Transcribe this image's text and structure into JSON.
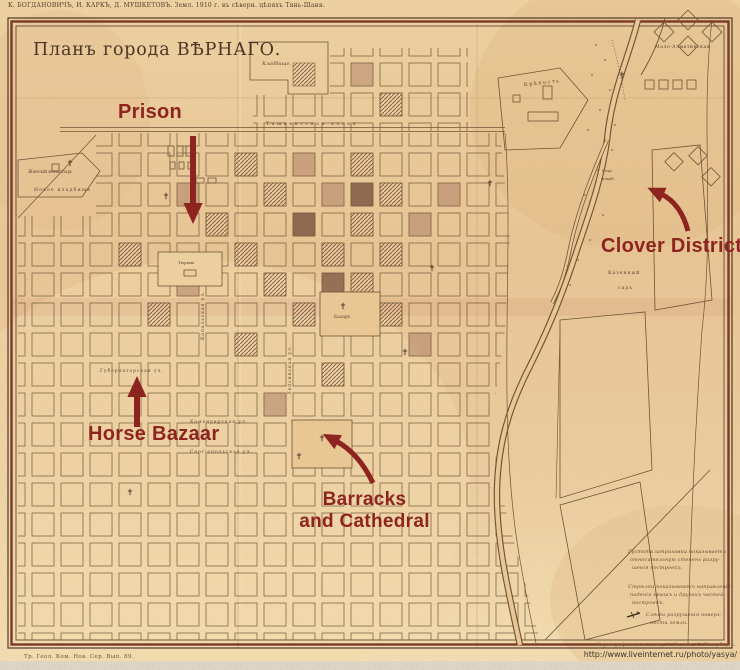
{
  "colors": {
    "annotation_red": "#8e2420",
    "paper": "#e8c795",
    "ink": "#5b4430"
  },
  "header": {
    "top_caption": "К. БОГДАНОВИЧЪ, И. КАРКЪ, Д. МУШКЕТОВЪ.  Земл. 1910 г. въ сѣверн. цѣпяхъ Тянь-Шаня.",
    "title": "Планъ города ВѢРНАГО."
  },
  "annotations": {
    "prison": "Prison",
    "clover_district": "Clover District",
    "horse_bazaar": "Horse Bazaar",
    "barracks_line1": "Barracks",
    "barracks_line2": "and Cathedral"
  },
  "map_labels": {
    "cemetery": "Кладбище.",
    "fortress": "Крѣпость",
    "convent": "Женскій монастырь",
    "new_cemetery": "Новое кладбище",
    "prison_block": "Тюрьма",
    "tashkent_alley": "Ташкентская  аллея",
    "gubernatorskaya": "Губернаторская ул.",
    "komandirskaya": "Командирская ул.",
    "sergiopolskaya": "Сергіопольская ул.",
    "kopalskaya": "Копальская ул.",
    "lepsinskaya": "Лепсинская ул.",
    "bazaar": "Базаръ",
    "state_garden_line1": "Казенный",
    "state_garden_line2": "садъ",
    "old_cemetery_line1": "Стар.",
    "old_cemetery_line2": "кладб.",
    "malo_almatinskaya": "Мало-Алматинская"
  },
  "legend": {
    "l1": "Густота штриховки показываетъ",
    "l2": "относительную степень разру-",
    "l3": "шенія построекъ.",
    "l4": "Стрѣлки показываютъ направленіе",
    "l5": "паденія крышъ и другихъ частей",
    "l6": "построекъ.",
    "l7": "Слѣды разрушенія поверх-",
    "l8": "ности земли."
  },
  "footer": {
    "series_caption": "Тр. Геол. Ком. Нов. Сер. Вып. 89.",
    "credit": "Картографическое завед. А. Ильина, С.-Петербургъ.",
    "url": "http://www.liveinternet.ru/photo/yasya/"
  }
}
